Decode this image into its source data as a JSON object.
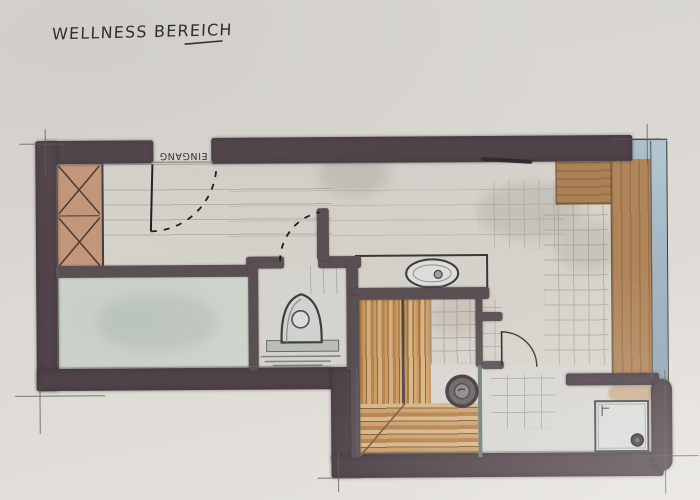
{
  "title": "WELLNESS BEREICH",
  "labels": {
    "entrance": "EINGANG"
  },
  "plan": {
    "type": "hand-drawn watercolor floor plan",
    "features": [
      "entrance-door",
      "wardrobe",
      "green-floor-room",
      "toilet",
      "washbasin-counter",
      "sauna-wood-benches",
      "sauna-heater",
      "passage-door",
      "relax-bench",
      "glass-wall",
      "shower-tray",
      "shower-drain",
      "pencil-tile-grids",
      "extension-lines"
    ]
  },
  "colors": {
    "paper": "#dcd9d4",
    "wall_dark": "#4f4349",
    "wall_interior": "#5a5054",
    "floor": "#d6d3cd",
    "floor_green": "#ccd3ca",
    "wood_light": "#d2ad7c",
    "wood_mid": "#b5814e",
    "wood_dark": "#8a5e33",
    "counter_brown": "#a97e63",
    "glass_blue": "#a9becb",
    "pencil_grey": "#8d8d85",
    "ink_black": "#222222"
  }
}
